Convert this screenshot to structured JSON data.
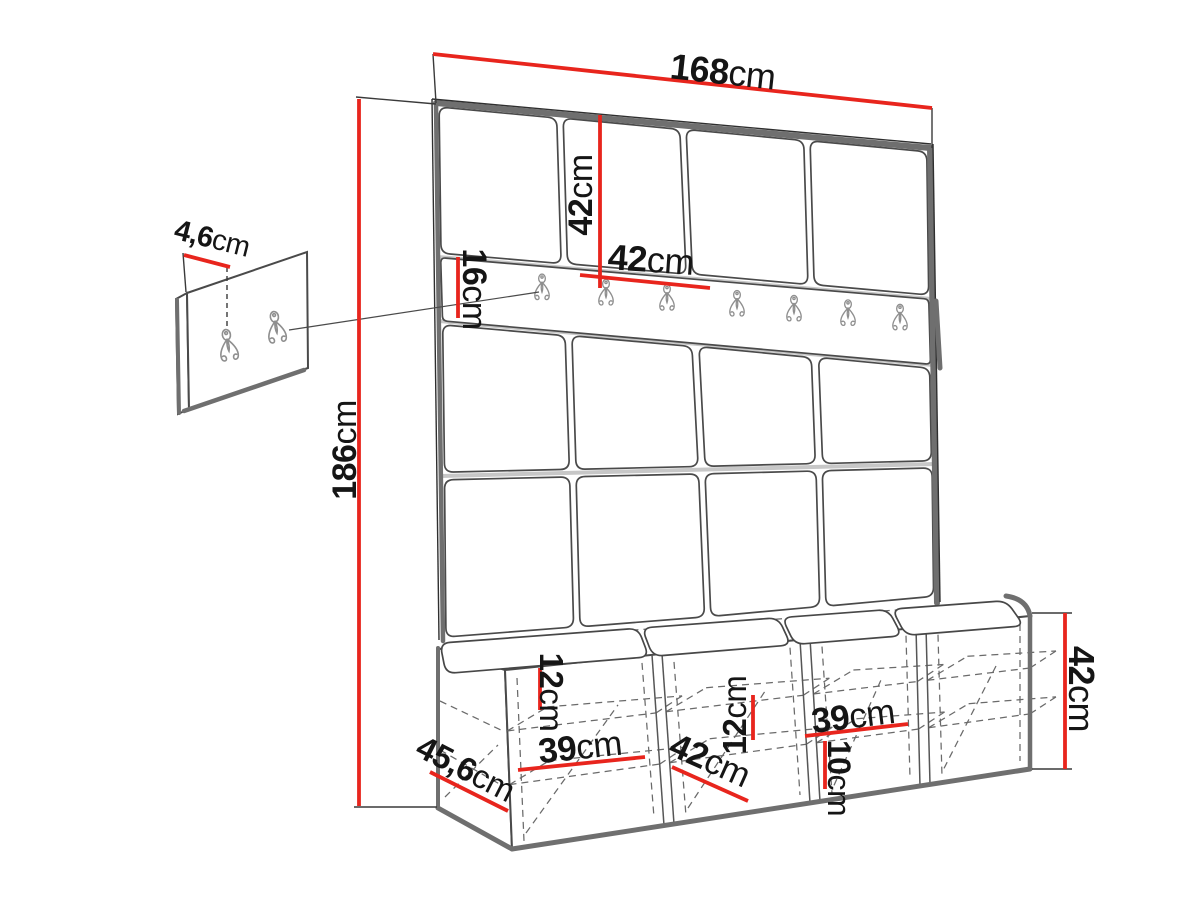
{
  "scene": {
    "background": "#ffffff",
    "dimension_color": "#e8251d",
    "sketch_color": "#4a4a4a",
    "unit": "cm"
  },
  "labels": {
    "total_width": {
      "value": "168",
      "unit": "cm"
    },
    "total_height": {
      "value": "186",
      "unit": "cm"
    },
    "panel_height": {
      "value": "42",
      "unit": "cm"
    },
    "panel_width": {
      "value": "42",
      "unit": "cm"
    },
    "rail_height": {
      "value": "16",
      "unit": "cm"
    },
    "side_panel_thickness": {
      "value": "4,6",
      "unit": "cm"
    },
    "bench_depth": {
      "value": "45,6",
      "unit": "cm"
    },
    "shelf_gap_1": {
      "value": "12",
      "unit": "cm"
    },
    "comp1_width": {
      "value": "39",
      "unit": "cm"
    },
    "comp2_width": {
      "value": "42",
      "unit": "cm"
    },
    "shelf_gap_2": {
      "value": "12",
      "unit": "cm"
    },
    "comp3_width": {
      "value": "39",
      "unit": "cm"
    },
    "plinth_height": {
      "value": "10",
      "unit": "cm"
    },
    "bench_height": {
      "value": "42",
      "unit": "cm"
    }
  },
  "counts": {
    "wall_panel_columns": 4,
    "wall_panel_rows": 4,
    "rail_hooks": 7,
    "side_panel_hooks": 2,
    "bench_compartments": 4,
    "bench_cushions": 4
  }
}
